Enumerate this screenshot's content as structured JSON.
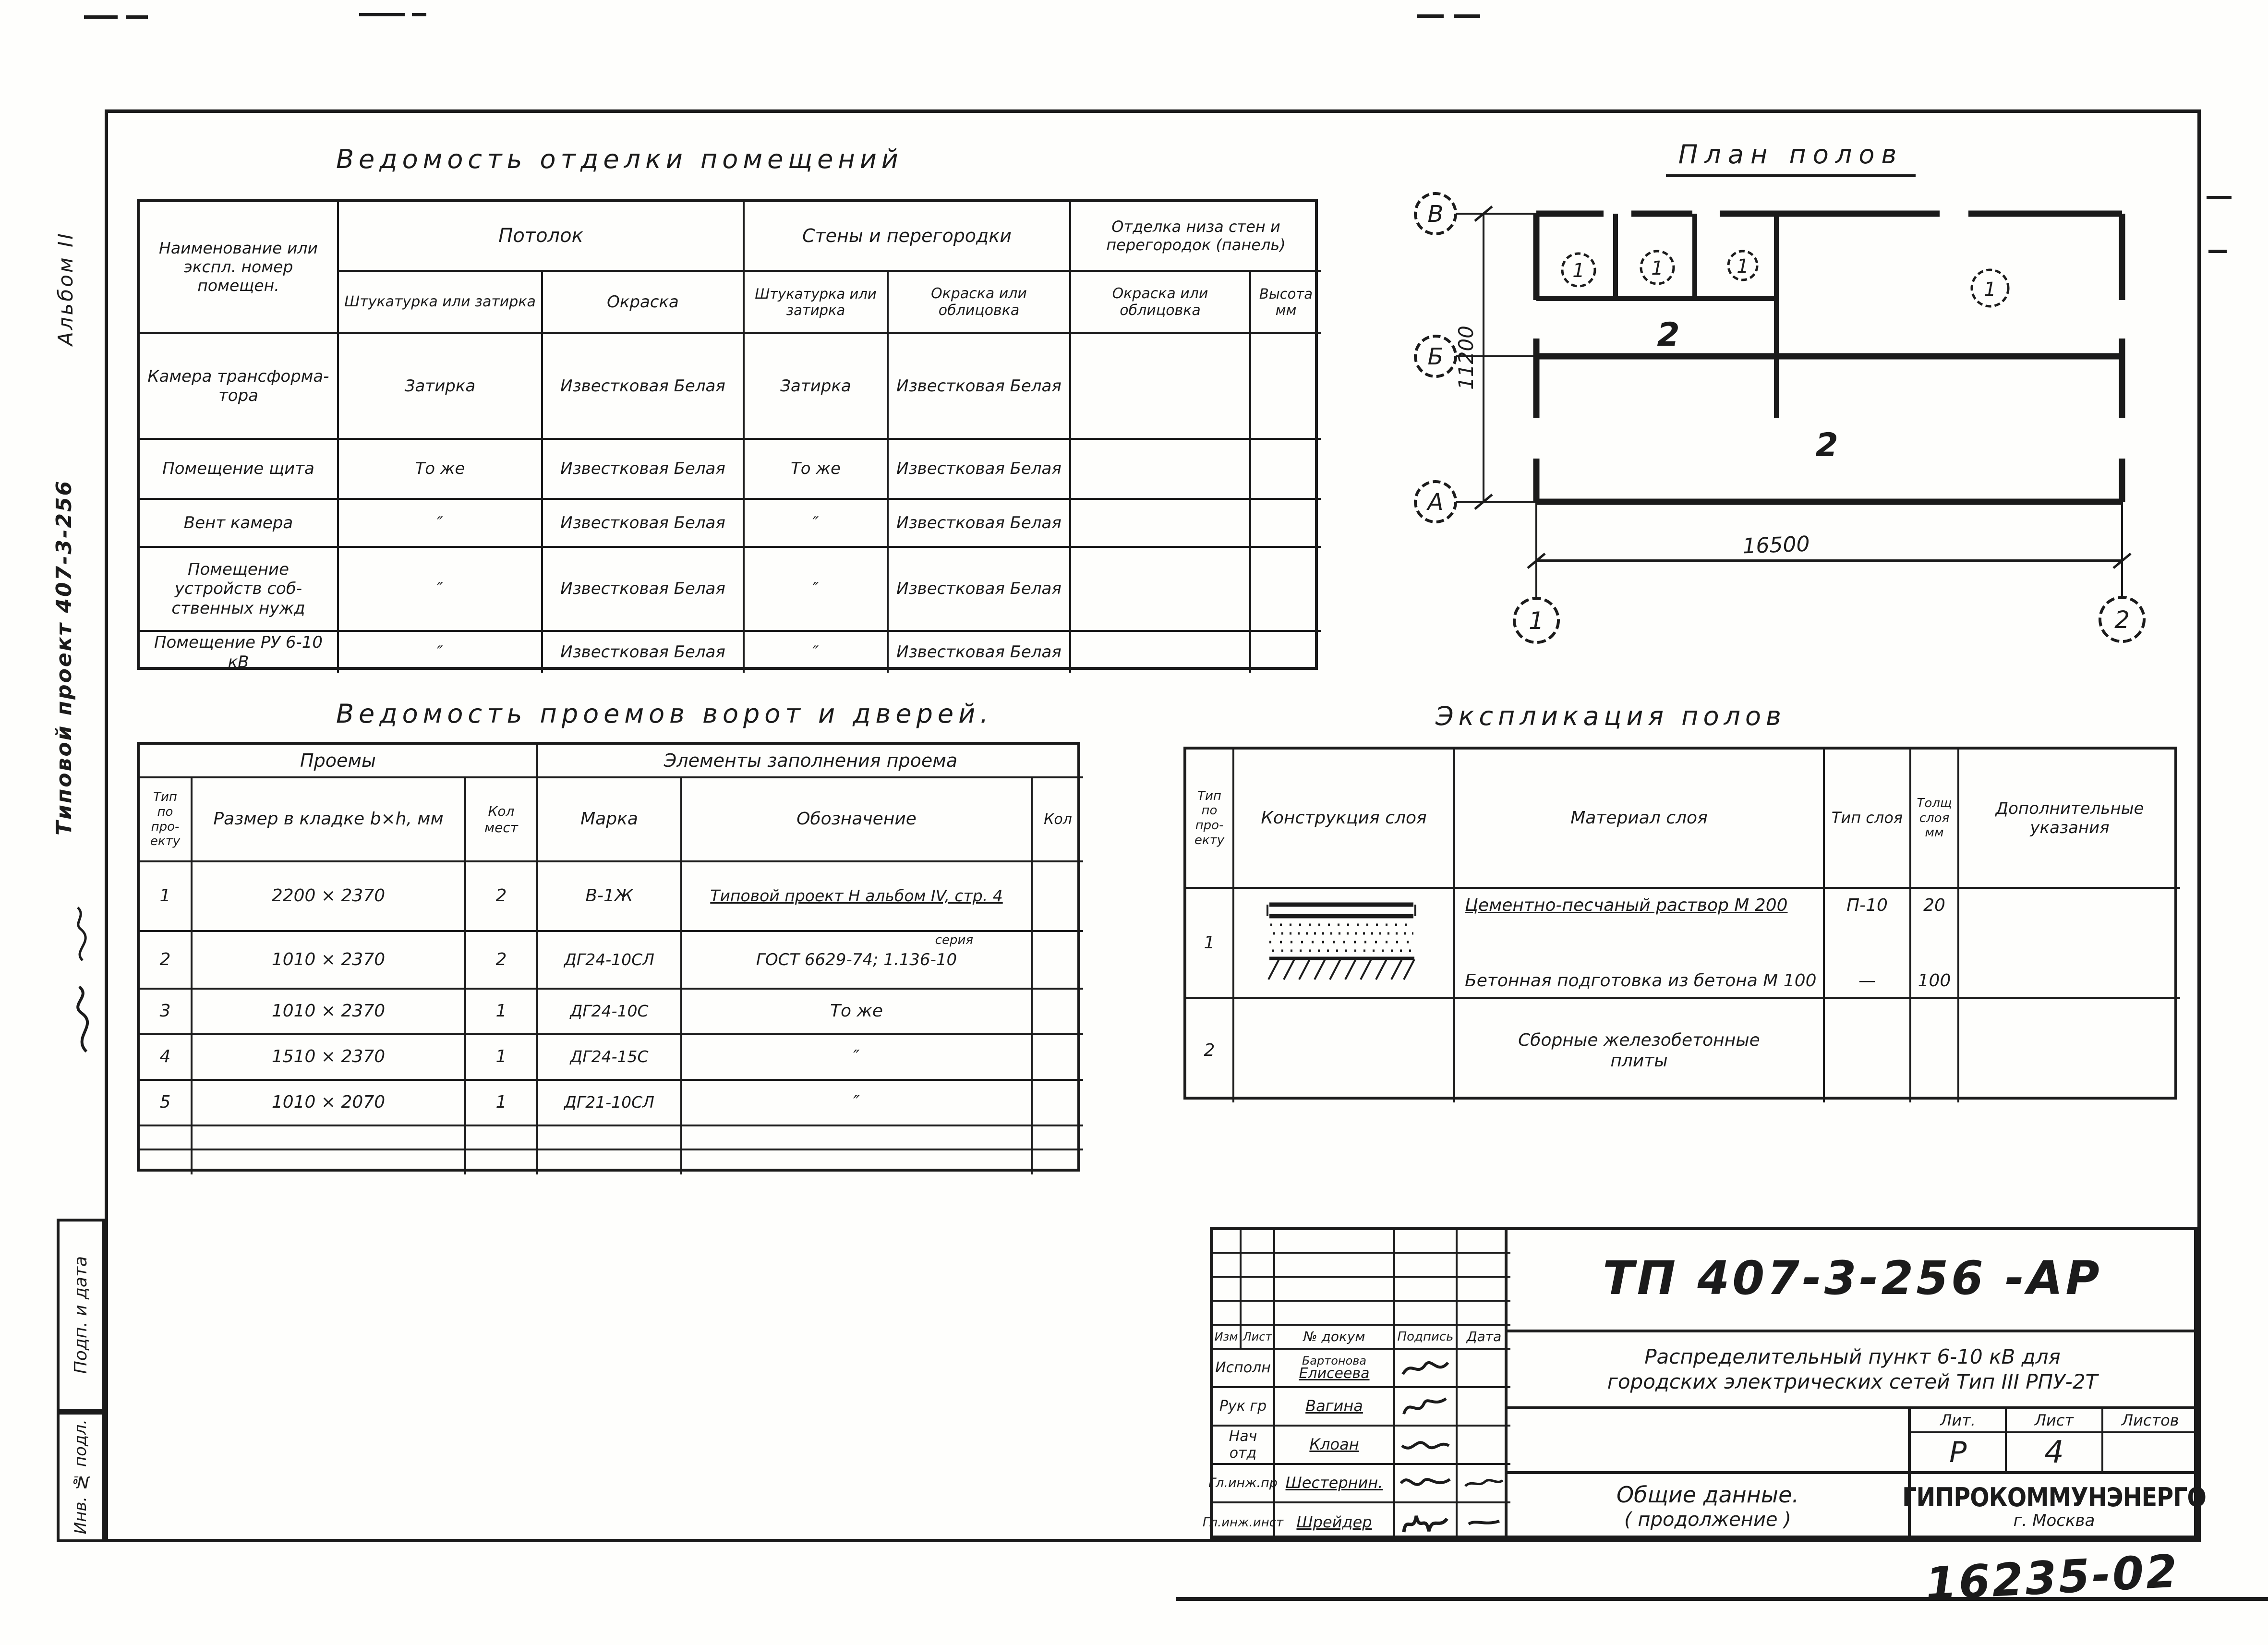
{
  "margin": {
    "album_note": "Альбом II",
    "project_note": "Типовой проект 407-3-256",
    "box_sign_date": "Подп. и дата",
    "box_inv": "Инв. № подл.",
    "doc_number_handwritten": "16235-02"
  },
  "finish_table": {
    "title": "Ведомость отделки помещений",
    "col_name": "Наименование или экспл. номер помещен.",
    "group_ceiling": "Потолок",
    "group_walls": "Стены и перегородки",
    "group_panel": "Отделка низа стен и перегородок (панель)",
    "sub_plaster_ceiling": "Штукатурка или затирка",
    "sub_paint_ceiling": "Окраска",
    "sub_plaster_walls": "Штукатурка или затирка",
    "sub_paint_walls": "Окраска или облицовка",
    "sub_paint_panel": "Окраска или облицовка",
    "sub_height": "Высота мм",
    "rows": [
      {
        "name": "Камера трансформа­тора",
        "c2": "Затирка",
        "c3": "Известковая Белая",
        "c4": "Затирка",
        "c5": "Известковая Белая",
        "c6": "",
        "c7": ""
      },
      {
        "name": "Помещение щита",
        "c2": "То же",
        "c3": "Известковая Белая",
        "c4": "То же",
        "c5": "Известковая Белая",
        "c6": "",
        "c7": ""
      },
      {
        "name": "Вент камера",
        "c2": "″",
        "c3": "Известковая Белая",
        "c4": "″",
        "c5": "Известковая Белая",
        "c6": "",
        "c7": ""
      },
      {
        "name": "Помещение устройств соб­ственных нужд",
        "c2": "″",
        "c3": "Известковая Белая",
        "c4": "″",
        "c5": "Известковая Белая",
        "c6": "",
        "c7": ""
      },
      {
        "name": "Помещение РУ 6-10 кВ",
        "c2": "″",
        "c3": "Известковая Белая",
        "c4": "″",
        "c5": "Известковая Белая",
        "c6": "",
        "c7": ""
      }
    ]
  },
  "openings_table": {
    "title": "Ведомость проемов ворот и дверей.",
    "group_openings": "Проемы",
    "group_fill": "Элементы заполнения проема",
    "col_type": "Тип по про­екту",
    "col_size": "Размер в кладке b×h, мм",
    "col_places": "Кол мест",
    "col_mark": "Марка",
    "col_designation": "Обозначение",
    "col_qty": "Кол",
    "rows": [
      {
        "type": "1",
        "size": "2200 × 2370",
        "places": "2",
        "mark": "В-1Ж",
        "designation": "Типовой проект Н альбом IV, стр. 4",
        "note": "",
        "qty": ""
      },
      {
        "type": "2",
        "size": "1010 × 2370",
        "places": "2",
        "mark": "ДГ24-10СЛ",
        "designation": "ГОСТ 6629-74; 1.136-10",
        "note": "серия",
        "qty": ""
      },
      {
        "type": "3",
        "size": "1010 × 2370",
        "places": "1",
        "mark": "ДГ24-10С",
        "designation": "То же",
        "note": "",
        "qty": ""
      },
      {
        "type": "4",
        "size": "1510 × 2370",
        "places": "1",
        "mark": "ДГ24-15С",
        "designation": "″",
        "note": "",
        "qty": ""
      },
      {
        "type": "5",
        "size": "1010 × 2070",
        "places": "1",
        "mark": "ДГ21-10СЛ",
        "designation": "″",
        "note": "",
        "qty": ""
      }
    ]
  },
  "floors_table": {
    "title": "Экспликация полов",
    "col_type": "Тип по про­екту",
    "col_construction": "Конструкция слоя",
    "col_material": "Материал слоя",
    "col_layer_type": "Тип слоя",
    "col_thickness": "Толщ слоя мм",
    "col_notes": "Дополнительные указания",
    "row1": {
      "type": "1",
      "material_a": "Цементно-песчаный раствор М 200",
      "material_b": "Бетонная подготовка из бетона М 100",
      "layer_a": "П-10",
      "layer_b": "—",
      "thick_a": "20",
      "thick_b": "100",
      "notes": ""
    },
    "row2": {
      "type": "2",
      "material": "Сборные железобетонные плиты",
      "layer": "",
      "thick": "",
      "notes": ""
    }
  },
  "plan": {
    "title": "План полов",
    "axis_v": "В",
    "axis_b": "Б",
    "axis_a": "А",
    "axis_1": "1",
    "axis_2": "2",
    "dim_vertical": "11200",
    "dim_horizontal": "16500",
    "mark1": "1",
    "mark2": "1",
    "mark3": "1",
    "mark4": "1",
    "zone1": "2",
    "zone2": "2"
  },
  "title_block": {
    "doc_code": "ТП 407-3-256   -АР",
    "project_line1": "Распределительный пункт 6-10 кВ для",
    "project_line2": "городских электрических сетей Тип III РПУ-2Т",
    "rev_headers": [
      "Изм",
      "Лист",
      "№ докум",
      "Подпись",
      "Дата"
    ],
    "staff": [
      {
        "role": "Исполн",
        "name": "Бартонова",
        "name2": "Елисеева"
      },
      {
        "role": "Рук гр",
        "name": "Вагина",
        "name2": ""
      },
      {
        "role": "Нач отд",
        "name": "Клоан",
        "name2": ""
      },
      {
        "role": "Гл.инж.пр",
        "name": "Шестернин.",
        "name2": ""
      },
      {
        "role": "Гл.инж.инст",
        "name": "Шрейдер",
        "name2": ""
      }
    ],
    "lit_label": "Лит.",
    "sheet_label": "Лист",
    "sheets_label": "Листов",
    "lit_value": "Р",
    "sheet_value": "4",
    "sheets_value": "",
    "subject_line1": "Общие  данные.",
    "subject_line2": "( продолжение )",
    "organization": "ГИПРОКОММУНЭНЕРГО",
    "org_city": "г. Москва"
  }
}
